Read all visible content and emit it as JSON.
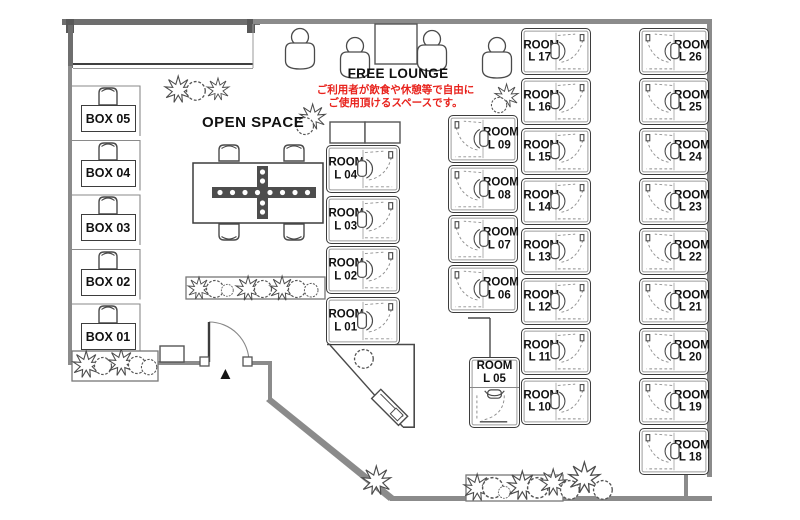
{
  "free_lounge": {
    "title": "FREE LOUNGE",
    "note_line1": "ご利用者が飲食や休憩等で自由に",
    "note_line2": "ご使用頂けるスペースです。"
  },
  "open_space": {
    "title": "OPEN SPACE"
  },
  "boxes": [
    {
      "label": "BOX 05"
    },
    {
      "label": "BOX 04"
    },
    {
      "label": "BOX 03"
    },
    {
      "label": "BOX 02"
    },
    {
      "label": "BOX 01"
    }
  ],
  "rooms": {
    "prefix": "ROOM",
    "columns": [
      {
        "names": [
          "L 04",
          "L 03",
          "L 02",
          "L 01"
        ]
      },
      {
        "names": [
          "L 09",
          "L 08",
          "L 07",
          "L 06"
        ]
      },
      {
        "names": [
          "L 17",
          "L 16",
          "L 15",
          "L 14",
          "L 13",
          "L 12",
          "L 11",
          "L 10"
        ]
      },
      {
        "names": [
          "L 26",
          "L 25",
          "L 24",
          "L 23",
          "L 22",
          "L 21",
          "L 20",
          "L 19",
          "L 18"
        ]
      }
    ],
    "single": {
      "name": "L 05"
    }
  },
  "icons": {
    "entrance_marker": "▲"
  },
  "colors": {
    "note_red": "#e8231d",
    "wall_gray": "#8b8b8b",
    "wall_dark": "#6e6e6e",
    "line_dark": "#3f3f3f",
    "table_cross": "#4d4d4d"
  }
}
